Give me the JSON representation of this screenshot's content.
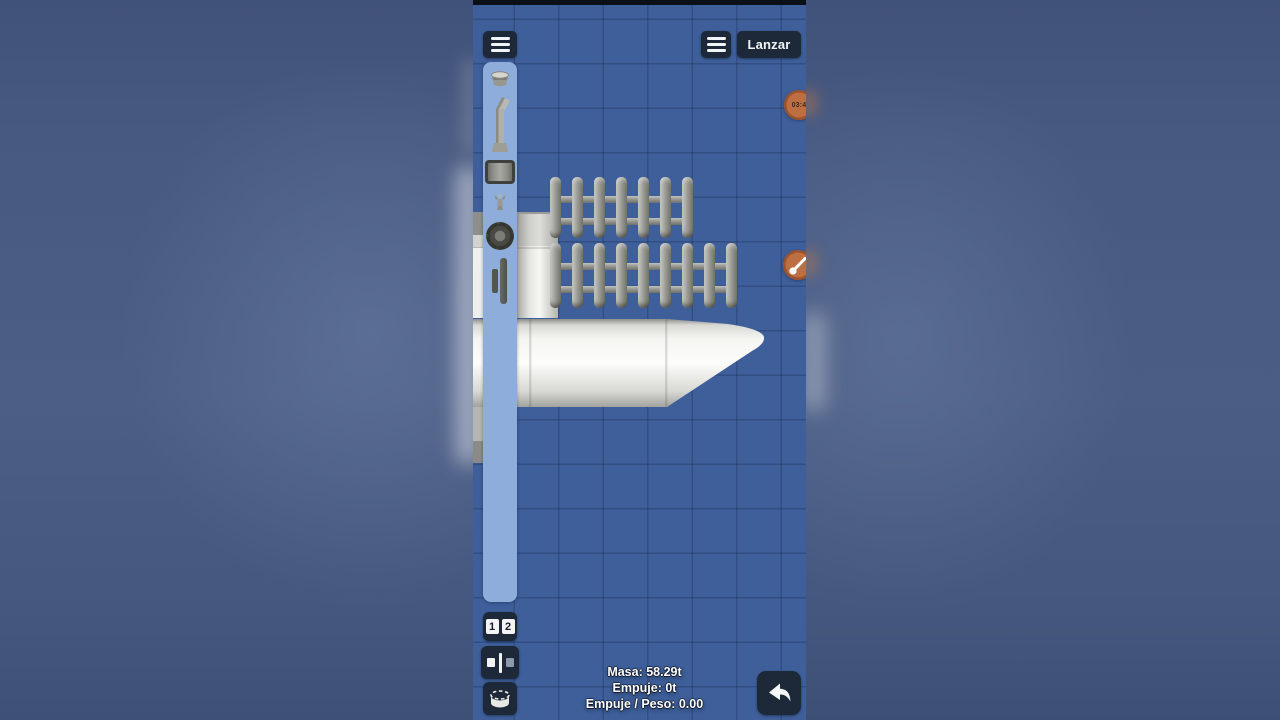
{
  "top_bar": {
    "left_icon": "hamburger-menu-icon",
    "right_icon": "hamburger-menu-icon",
    "launch_label": "Lanzar"
  },
  "sidebar": {
    "part_icons": [
      "capsule-icon",
      "engine-icon",
      "fuel-tank-icon",
      "rcs-thruster-icon",
      "reaction-wheel-icon",
      "separator-icon"
    ]
  },
  "rocket": {
    "fence_rows": [
      {
        "slats": 7
      },
      {
        "slats": 9
      }
    ],
    "parts_visible": [
      "side-stack",
      "vertical-tank",
      "radiator-row-top",
      "radiator-row-bottom",
      "fuel-tank",
      "nose-cone"
    ]
  },
  "overlays": {
    "timestamp_badge": "03:4",
    "paint_badge_icon": "paintbrush-icon"
  },
  "bottom_left": {
    "stage_buttons": [
      "1",
      "2"
    ],
    "icons": [
      "symmetry-icon",
      "rotate-part-icon"
    ]
  },
  "bottom_right": {
    "icon": "undo-icon"
  },
  "stats": {
    "mass": "Masa: 58.29t",
    "thrust": "Empuje: 0t",
    "ratio": "Empuje / Peso: 0.00"
  },
  "colors": {
    "blueprint_bg": "#3e5f9a",
    "grid_line": "#35538a",
    "sidebar_panel": "#8fadda",
    "dark_button": "#1d2938",
    "accent_orange": "#bd6f43",
    "part_gray": "#96968f",
    "tank_white": "#f7f7f4",
    "letterbox_blue": "#4b5d84"
  }
}
